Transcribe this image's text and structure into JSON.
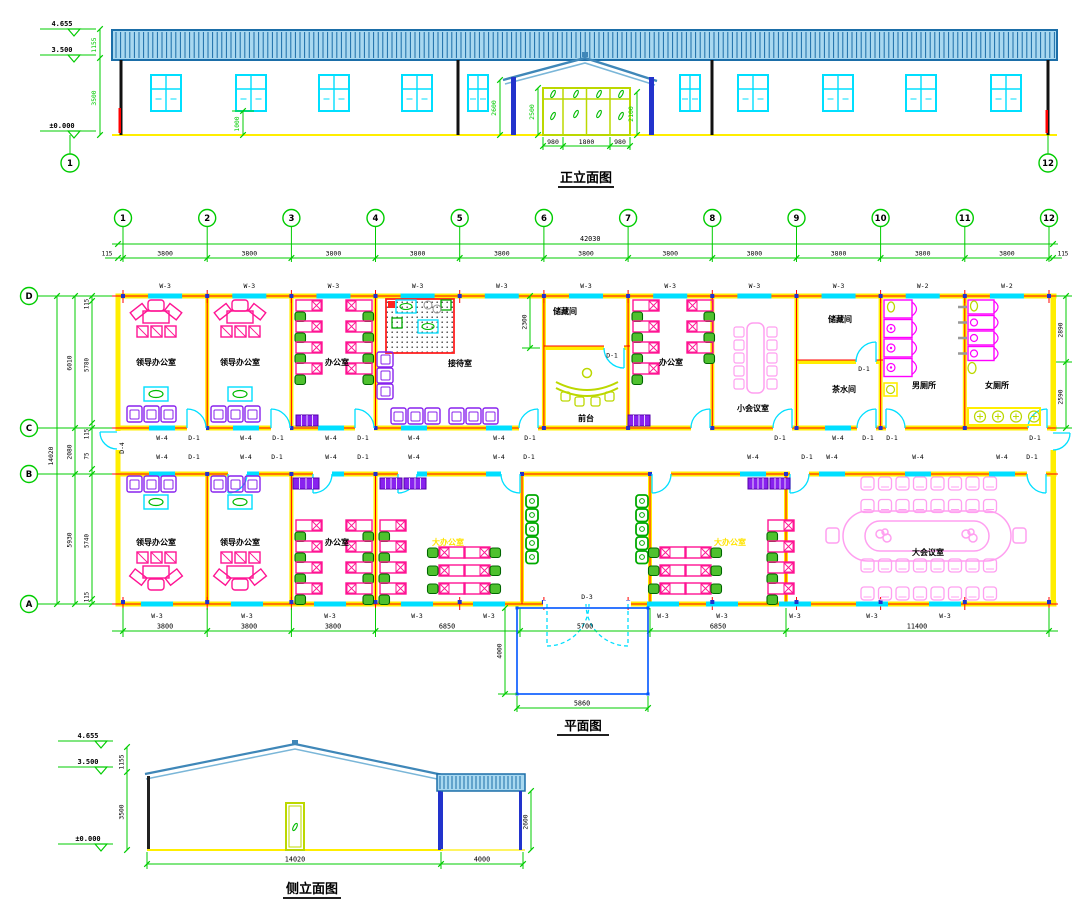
{
  "titles": {
    "front": "正立面图",
    "plan": "平面图",
    "side": "侧立面图"
  },
  "front_elevation": {
    "levels": {
      "parapet": "4.655",
      "eave": "3.500",
      "ground": "±0.000"
    },
    "dims": {
      "band_height": "1155",
      "wall_height": "3500",
      "window_sill": "1000",
      "porch_height": "2600",
      "door_frame_height": "2500",
      "door_height": "2100",
      "door_widths": [
        "980",
        "1800",
        "980"
      ]
    },
    "axis_left": "1",
    "axis_right": "12"
  },
  "plan": {
    "axis_cols": [
      "1",
      "2",
      "3",
      "4",
      "5",
      "6",
      "7",
      "8",
      "9",
      "10",
      "11",
      "12"
    ],
    "axis_rows": [
      "D",
      "C",
      "B",
      "A"
    ],
    "dims": {
      "total_width": "42030",
      "bay": "3800",
      "edge": "115",
      "total_depth": "14020",
      "depth_segments": [
        "6010",
        "2080",
        "5930"
      ],
      "depth_inner": [
        "115",
        "5780",
        "115",
        "75",
        "5740",
        "115"
      ],
      "right_segments": [
        "2890",
        "2590"
      ],
      "bottom": [
        "3800",
        "3800",
        "3800",
        "6850",
        "5700",
        "6850",
        "11400"
      ],
      "front_room_depth": "2300",
      "porch_depth": "4000",
      "porch_width": "5860"
    },
    "tags": {
      "w2": "W-2",
      "w3": "W-3",
      "w4": "W-4",
      "d1": "D-1",
      "d3": "D-3",
      "d4": "D-4"
    },
    "rooms": {
      "leader_office": "领导办公室",
      "office": "办公室",
      "reception": "接待室",
      "storage": "储藏间",
      "front_desk": "前台",
      "small_meeting": "小会议室",
      "tea_room": "茶水间",
      "mens_toilet": "男厕所",
      "womens_toilet": "女厕所",
      "big_office": "大办公室",
      "big_meeting": "大会议室"
    }
  },
  "side_elevation": {
    "levels": {
      "ridge": "4.655",
      "eave": "3.500",
      "ground": "±0.000"
    },
    "dims": {
      "band_height": "1155",
      "wall_height": "3500",
      "canopy_height": "2600",
      "building_width": "14020",
      "canopy_width": "4000"
    }
  },
  "colors": {
    "dimension_green": "#00cc00",
    "axis_red": "#ff0000",
    "wall_yellow": "#ffee00",
    "glazing_cyan": "#00dfff",
    "furniture_pink": "#ff1493",
    "fixture_magenta": "#ff00ff",
    "meeting_pink": "#ff9ff0",
    "sofa_purple": "#8822ee",
    "counter_lime": "#bcd800",
    "chair_green": "#4ec12e",
    "roof_blue": "#1b6ea8",
    "roof_fill": "#a8d8f0",
    "column_blue": "#2233cc",
    "porch_blue": "#0055ff",
    "big_office_label": "#ffe400"
  }
}
